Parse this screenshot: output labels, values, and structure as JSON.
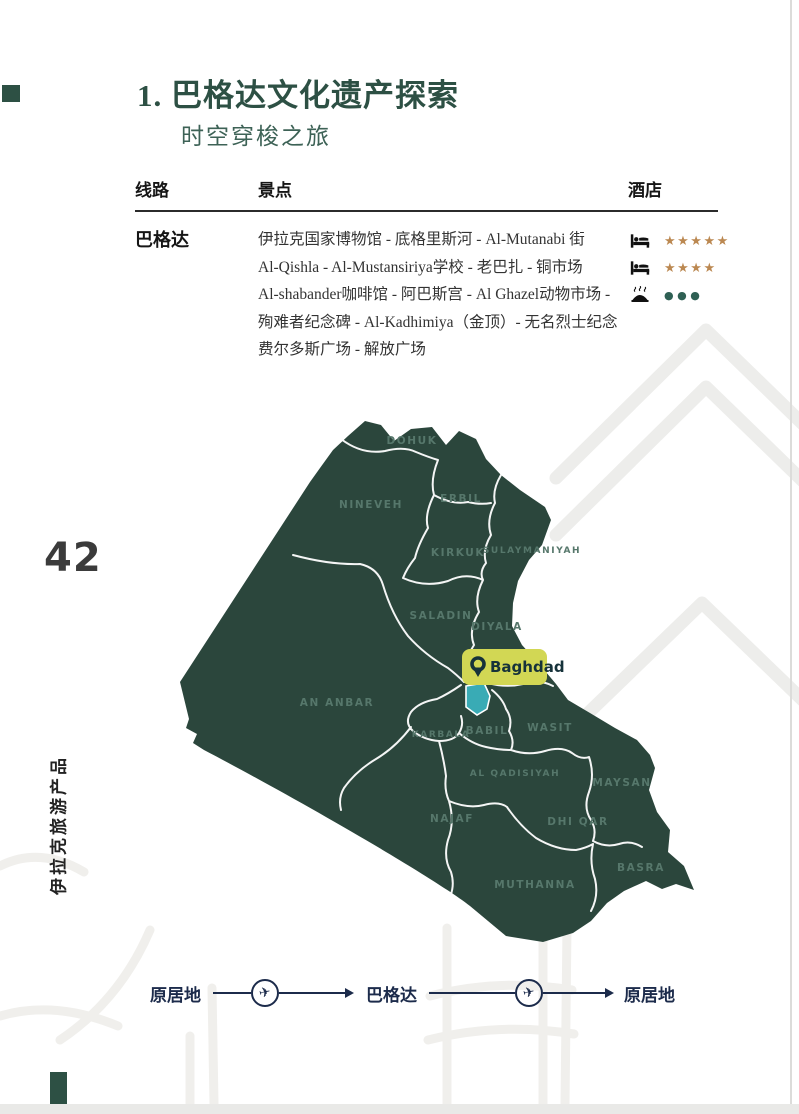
{
  "page": {
    "number": "42",
    "side_label": "伊拉克旅游产品"
  },
  "header": {
    "title": "1. 巴格达文化遗产探索",
    "subtitle": "时空穿梭之旅"
  },
  "table": {
    "columns": {
      "route": "线路",
      "attractions": "景点",
      "hotel": "酒店"
    },
    "row": {
      "route": "巴格达",
      "attraction_lines": [
        "伊拉克国家博物馆 - 底格里斯河 - Al-Mutanabi 街",
        "Al-Qishla - Al-Mustansiriya学校 - 老巴扎 - 铜市场",
        "Al-shabander咖啡馆 - 阿巴斯宫 - Al Ghazel动物市场 -",
        "殉难者纪念碑 - Al-Kadhimiya（金顶）- 无名烈士纪念",
        "费尔多斯广场 - 解放广场"
      ],
      "ratings": [
        {
          "icon": "bed-icon",
          "stars": 5,
          "display": "★★★★★"
        },
        {
          "icon": "bed-icon",
          "stars": 4,
          "display": "★★★★"
        },
        {
          "icon": "restaurant-icon",
          "dots": 3,
          "display": "●●●"
        }
      ]
    }
  },
  "map": {
    "marker_label": "Baghdad",
    "provinces": [
      "DOHUK",
      "NINEVEH",
      "ERBIL",
      "KIRKUK",
      "SULAYMANIYAH",
      "SALADIN",
      "DIYALA",
      "AN ANBAR",
      "KARBALA",
      "BABIL",
      "WASIT",
      "AL QADISIYAH",
      "MAYSAN",
      "NAJAF",
      "DHI QAR",
      "MUTHANNA",
      "BASRA"
    ]
  },
  "journey": {
    "origin": "原居地",
    "destination": "巴格达",
    "return": "原居地"
  },
  "colors": {
    "map_green": "#2b463c",
    "title_green": "#2d5044",
    "marker_yellow": "#d2d754",
    "highlight_teal": "#39abb5",
    "star_gold": "#bb8851",
    "dot_green": "#2f6054",
    "journey_navy": "#1c2b4b"
  }
}
